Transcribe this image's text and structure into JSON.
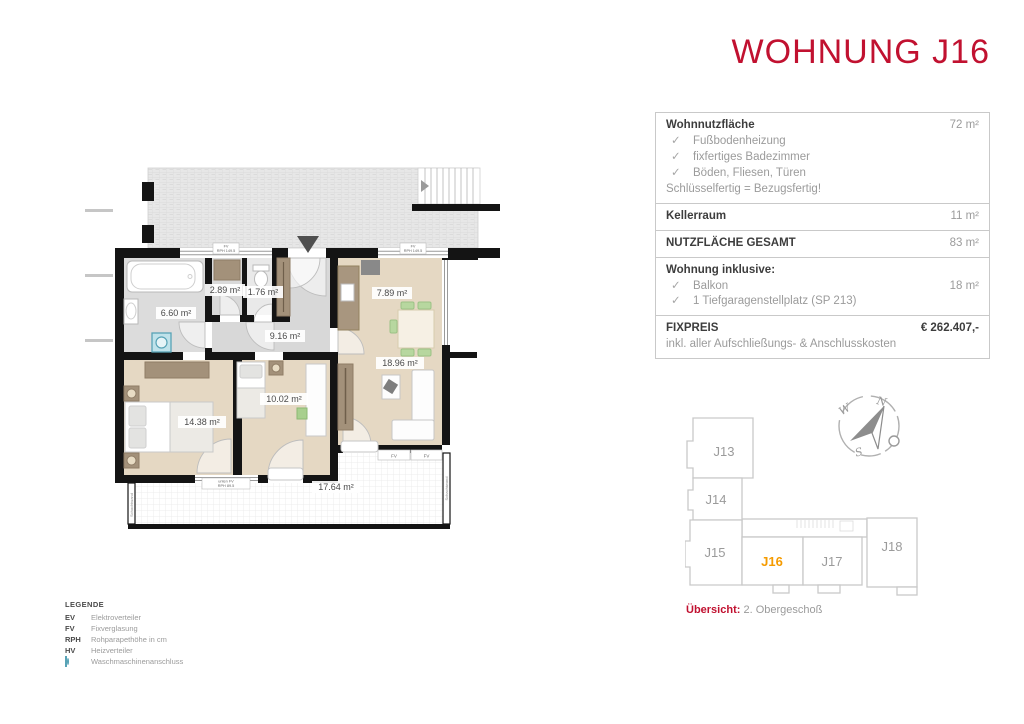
{
  "title": "WOHNUNG J16",
  "colors": {
    "red": "#c11130",
    "orange": "#f59b00"
  },
  "info": {
    "check_glyph": "✓",
    "wohnnutz_label": "Wohnnutzfläche",
    "wohnnutz_value": "72 m²",
    "checks": [
      "Fußbodenheizung",
      "fixfertiges Badezimmer",
      "Böden, Fliesen, Türen"
    ],
    "note": "Schlüsselfertig = Bezugsfertig!",
    "keller_label": "Kellerraum",
    "keller_value": "11 m²",
    "gesamt_label": "NUTZFLÄCHE GESAMT",
    "gesamt_value": "83 m²",
    "inklusive_label": "Wohnung inklusive:",
    "balkon_label": "Balkon",
    "balkon_value": "18 m²",
    "garage_label": "1 Tiefgaragenstellplatz (SP 213)",
    "fixpreis_label": "FIXPREIS",
    "fixpreis_value": "€ 262.407,-",
    "fixpreis_note": "inkl. aller Aufschließungs- & Anschlusskosten"
  },
  "floorplan": {
    "areas": {
      "bad": "6.60 m²",
      "abstellraum": "2.89 m²",
      "wc": "1.76 m²",
      "flur": "9.16 m²",
      "kueche": "7.89 m²",
      "wohnzimmer": "18.96 m²",
      "schlafzimmer": "14.38 m²",
      "zimmer": "10.02 m²",
      "balkon": "17.64 m²"
    },
    "tags": {
      "fv": "FV",
      "fv_rph": "RPH 149.5",
      "unten_fv": "unten FV",
      "unten_rph": "RPH 89.5",
      "schachtwand": "Schachtwand"
    }
  },
  "legend": {
    "title": "LEGENDE",
    "items": [
      {
        "abbr": "EV",
        "text": "Elektroverteiler"
      },
      {
        "abbr": "FV",
        "text": "Fixverglasung"
      },
      {
        "abbr": "RPH",
        "text": "Rohparapethöhe in cm"
      },
      {
        "abbr": "HV",
        "text": "Heizverteiler"
      }
    ],
    "washer_text": "Waschmaschinenanschluss"
  },
  "overview": {
    "units": [
      "J13",
      "J14",
      "J15",
      "J16",
      "J17",
      "J18"
    ],
    "highlight": "J16",
    "caption_label": "Übersicht:",
    "caption_text": "2. Obergeschoß"
  },
  "compass": {
    "n": "N",
    "w": "W",
    "s": "S"
  }
}
